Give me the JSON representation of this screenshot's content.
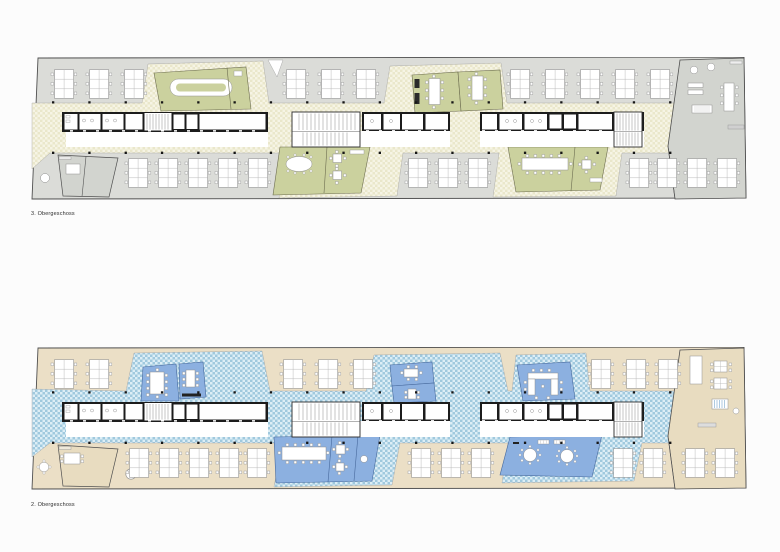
{
  "page": {
    "background": "#fcfcfc",
    "type_note": "architectural drawing sheet, two stacked floor plans"
  },
  "plans": [
    {
      "id": "og3",
      "label": "3. Obergeschoss",
      "colors": {
        "office": "#dbdcd8",
        "band_a": "#eae7cb",
        "band_b": "#f6f4e5",
        "room": "#cbd19e",
        "room_stroke": "#6d6d50",
        "lounge": "#d2d4cf"
      }
    },
    {
      "id": "og2",
      "label": "2. Obergeschoss",
      "colors": {
        "office": "#ebdfc6",
        "band_a": "#a0c9de",
        "band_b": "#ddeef6",
        "room": "#8cb0e0",
        "room_stroke": "#47699c",
        "lounge": "#e8dcc0"
      }
    }
  ],
  "shared": {
    "colors": {
      "background": "#fcfcfc",
      "wall": "#1c1c1c",
      "boundary": "#4f4f4f",
      "furniture": "#909090",
      "fixture": "#9a9a9a",
      "column": "#161616",
      "stair": "#8b8b8b",
      "corridor": "#ffffff",
      "lounger_stripe": "#7aa7cc"
    }
  }
}
